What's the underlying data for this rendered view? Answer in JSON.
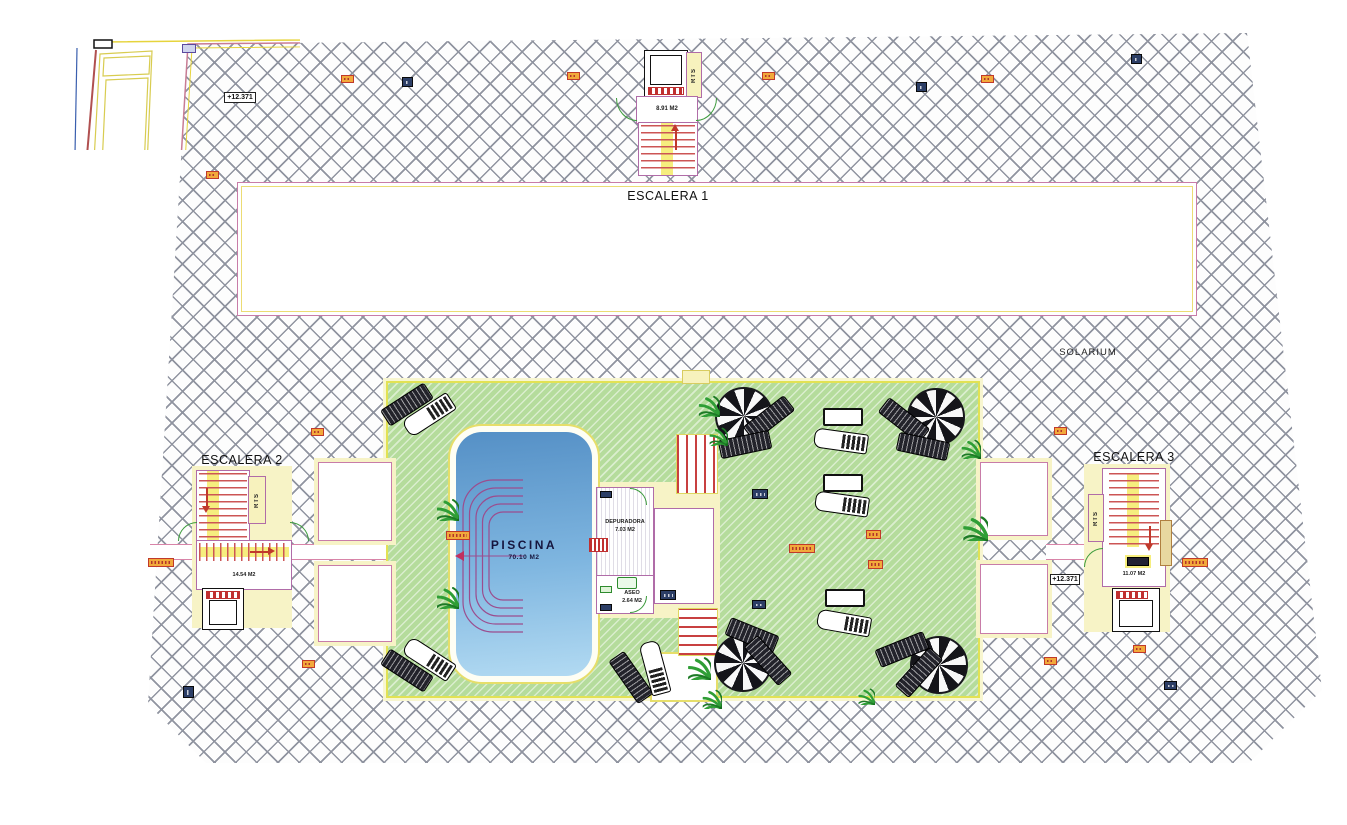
{
  "drawing": {
    "labels": {
      "escalera1": "ESCALERA 1",
      "escalera2": "ESCALERA 2",
      "escalera3": "ESCALERA 3",
      "solarium": "SOLARIUM",
      "piscina": "PISCINA",
      "piscina_area": "70.10 M2",
      "depuradora": "DEPURADORA",
      "depuradora_area": "7.03 M2",
      "aseo": "ASEO",
      "aseo_area": "2.64 M2",
      "escalera1_area": "8.91 M2",
      "escalera2_area": "14.54 M2",
      "escalera3_area": "11.07 M2",
      "rts": "RTS",
      "level_mark": "+12.371"
    },
    "colors": {
      "hatch_line": "#9094a0",
      "wall_pink": "#b06ca8",
      "boundary_yellow": "#e6d43c",
      "lawn_green": "#b5dc9c",
      "pool_blue": "#5e9ccb",
      "stair_yellow": "#f6ee7e",
      "accent_red": "#c0392b"
    },
    "skylights": [
      [
        318,
        462,
        72,
        77
      ],
      [
        318,
        565,
        72,
        75
      ],
      [
        980,
        462,
        66,
        72
      ],
      [
        980,
        564,
        66,
        68
      ]
    ],
    "tags": [
      [
        182,
        44,
        14,
        9,
        "purple",
        null
      ],
      [
        224,
        92,
        32,
        11,
        "white",
        "+12.371"
      ],
      [
        206,
        171,
        13,
        8,
        "orange",
        null
      ],
      [
        341,
        75,
        13,
        8,
        "orange",
        null
      ],
      [
        402,
        77,
        11,
        10,
        "blue",
        null
      ],
      [
        567,
        72,
        13,
        8,
        "orange",
        null
      ],
      [
        762,
        72,
        13,
        8,
        "orange",
        null
      ],
      [
        916,
        82,
        11,
        10,
        "blue",
        null
      ],
      [
        981,
        75,
        13,
        8,
        "orange",
        null
      ],
      [
        1131,
        54,
        11,
        10,
        "blue",
        null
      ],
      [
        311,
        428,
        13,
        8,
        "orange",
        null
      ],
      [
        1054,
        427,
        13,
        8,
        "orange",
        null
      ],
      [
        446,
        531,
        24,
        9,
        "orange",
        null
      ],
      [
        789,
        544,
        26,
        9,
        "orange",
        null
      ],
      [
        866,
        530,
        15,
        9,
        "orange",
        null
      ],
      [
        868,
        560,
        15,
        9,
        "orange",
        null
      ],
      [
        752,
        489,
        16,
        10,
        "blue",
        null
      ],
      [
        660,
        590,
        16,
        10,
        "blue",
        null
      ],
      [
        752,
        600,
        14,
        9,
        "blue",
        null
      ],
      [
        302,
        660,
        13,
        8,
        "orange",
        null
      ],
      [
        1044,
        657,
        13,
        8,
        "orange",
        null
      ],
      [
        1133,
        645,
        13,
        8,
        "orange",
        null
      ],
      [
        148,
        558,
        26,
        9,
        "orange",
        null
      ],
      [
        1182,
        558,
        26,
        9,
        "orange",
        null
      ],
      [
        183,
        686,
        11,
        12,
        "blue",
        null
      ],
      [
        1164,
        681,
        13,
        9,
        "blue",
        null
      ],
      [
        1050,
        574,
        30,
        11,
        "white",
        "+12.371"
      ],
      [
        600,
        491,
        12,
        7,
        "blue",
        null
      ],
      [
        600,
        586,
        12,
        7,
        "green",
        null
      ],
      [
        600,
        604,
        12,
        7,
        "blue",
        null
      ],
      [
        1127,
        557,
        22,
        9,
        "dark",
        null
      ]
    ],
    "palms": [
      [
        437,
        499,
        1.0
      ],
      [
        437,
        587,
        1.0
      ],
      [
        699,
        396,
        0.95
      ],
      [
        710,
        428,
        0.8
      ],
      [
        688,
        657,
        1.05
      ],
      [
        703,
        690,
        0.85
      ],
      [
        963,
        516,
        1.15
      ],
      [
        962,
        440,
        0.85
      ],
      [
        858,
        688,
        0.75
      ]
    ],
    "parasols": [
      [
        742,
        414,
        27
      ],
      [
        934,
        415,
        27
      ],
      [
        741,
        661,
        27
      ],
      [
        937,
        663,
        27
      ]
    ],
    "loungers": [
      [
        768,
        417,
        -38,
        "dark"
      ],
      [
        744,
        443,
        -12,
        "dark"
      ],
      [
        903,
        419,
        38,
        "dark"
      ],
      [
        922,
        445,
        12,
        "dark"
      ],
      [
        751,
        634,
        22,
        "dark"
      ],
      [
        767,
        659,
        48,
        "dark"
      ],
      [
        901,
        648,
        -22,
        "dark"
      ],
      [
        918,
        671,
        -48,
        "dark"
      ],
      [
        406,
        403,
        -33,
        "dark"
      ],
      [
        428,
        414,
        -33,
        "fancy"
      ],
      [
        406,
        669,
        33,
        "dark"
      ],
      [
        428,
        658,
        33,
        "fancy"
      ],
      [
        840,
        440,
        8,
        "fancy"
      ],
      [
        841,
        503,
        8,
        "fancy"
      ],
      [
        843,
        622,
        10,
        "fancy"
      ],
      [
        630,
        676,
        55,
        "dark"
      ],
      [
        654,
        667,
        75,
        "fancy"
      ]
    ],
    "tables": [
      [
        841,
        415
      ],
      [
        841,
        481
      ],
      [
        843,
        596
      ]
    ]
  }
}
